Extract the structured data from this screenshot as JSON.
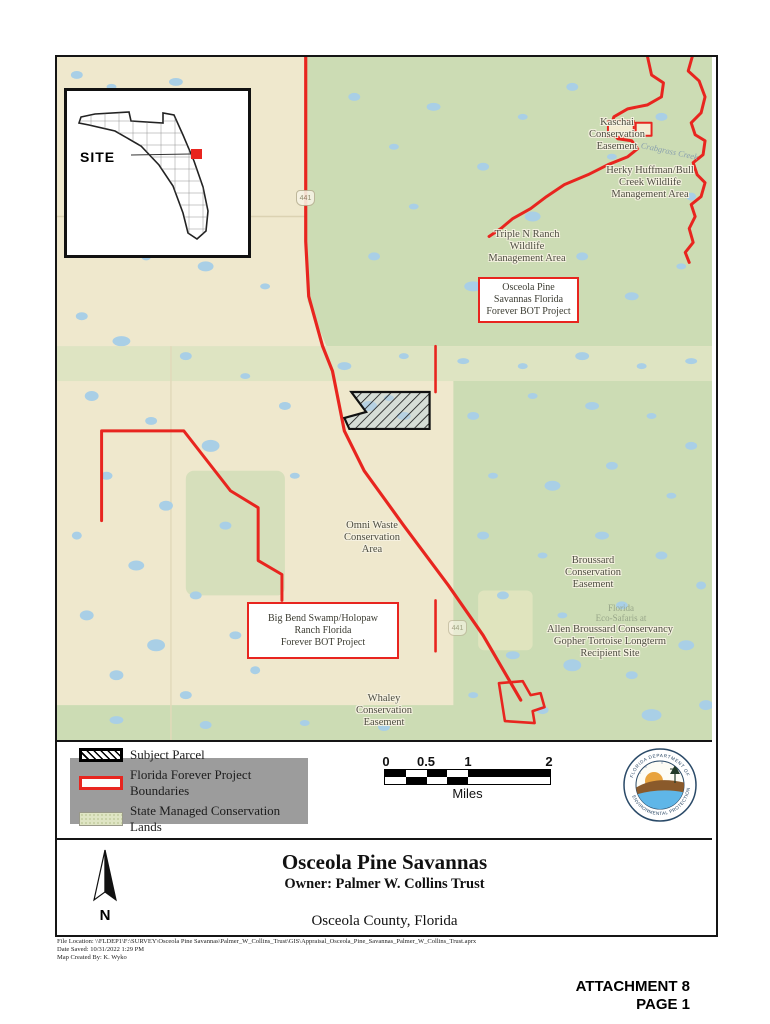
{
  "inset": {
    "site_label": "SITE"
  },
  "map": {
    "area_labels": [
      {
        "text": "Kaschai\nConservation\nEasement"
      },
      {
        "text": "Herky Huffman/Bull\nCreek Wildlife\nManagement Area"
      },
      {
        "text": "Triple N Ranch\nWildlife\nManagement Area"
      },
      {
        "text": "Omni Waste\nConservation\nArea"
      },
      {
        "text": "Broussard\nConservation\nEasement"
      },
      {
        "text": "Florida\nEco-Safaris at"
      },
      {
        "text": "Allen Broussard Conservancy\nGopher Tortoise Longterm\nRecipient Site"
      },
      {
        "text": "Whaley\nConservation\nEasement"
      },
      {
        "text": "Crabgrass Creek"
      }
    ],
    "project_boxes": [
      {
        "text": "Osceola Pine\nSavannas Florida\nForever BOT Project"
      },
      {
        "text": "Big Bend Swamp/Holopaw\nRanch Florida\nForever BOT Project"
      }
    ],
    "route_shields": [
      "441",
      "441"
    ],
    "colors": {
      "land_beige": "#efe8cd",
      "conservation_green": "#ccdcb4",
      "band_green": "#dee4c2",
      "water_blue": "#a9cfe6",
      "boundary_red": "#e8251f",
      "parcel_outline": "#111111"
    }
  },
  "legend": {
    "items": [
      {
        "label": "Subject Parcel",
        "swatch": "hatched-parcel"
      },
      {
        "label": "Florida Forever Project Boundaries",
        "swatch": "red-outline"
      },
      {
        "label": "State Managed Conservation Lands",
        "swatch": "green-fill"
      }
    ]
  },
  "scale_bar": {
    "ticks": [
      "0",
      "0.5",
      "1",
      "2"
    ],
    "unit": "Miles"
  },
  "logo": {
    "top_text": "FLORIDA DEPARTMENT OF",
    "bottom_text": "ENVIRONMENTAL PROTECTION"
  },
  "title_block": {
    "title": "Osceola Pine Savannas",
    "owner": "Owner: Palmer W. Collins Trust",
    "county": "Osceola County, Florida",
    "north_label": "N"
  },
  "footer": {
    "lines": "File Location: \\\\FLDEP1\\F:\\SURVEY\\Osceola Pine Savannas\\Palmer_W_Collins_Trust\\GIS\\Appraisal_Osceola_Pine_Savannas_Palmer_W_Collins_Trust.aprx\nDate Saved: 10/31/2022 1:29 PM\nMap Created By: K. Wyko"
  },
  "page_marks": {
    "attachment": "ATTACHMENT 8",
    "page_label": "PAGE 1"
  }
}
